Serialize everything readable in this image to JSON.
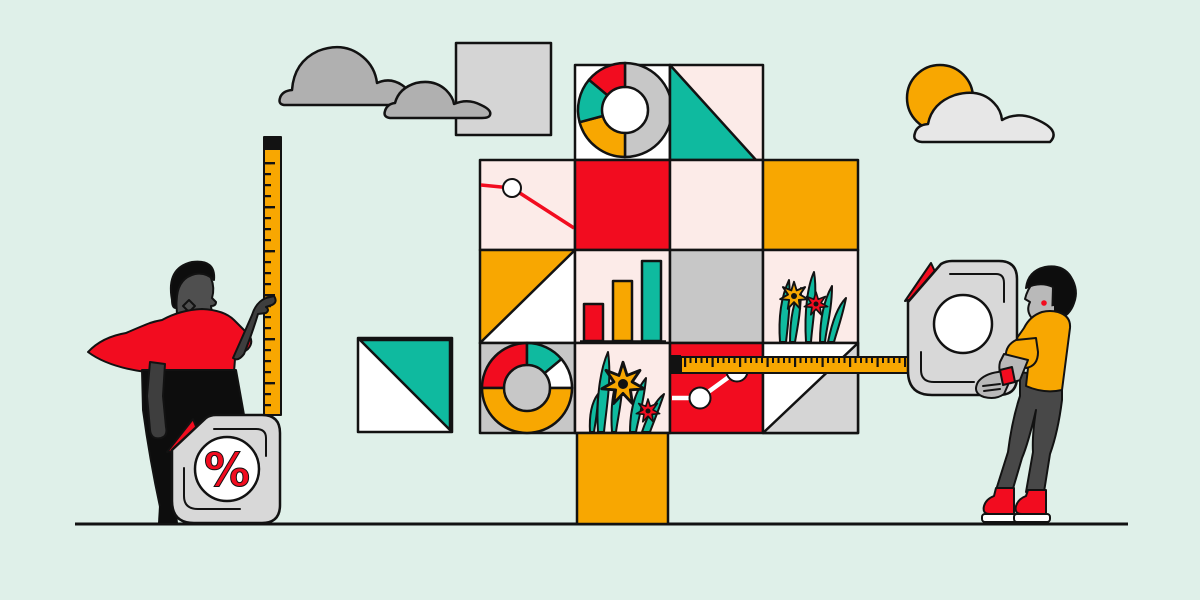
{
  "colors": {
    "bg": "#dff0e9",
    "outline": "#121212",
    "red": "#f20c1f",
    "orange": "#f8a701",
    "teal": "#0fba9f",
    "pink": "#fcebe8",
    "white": "#ffffff",
    "tile_grey": "#c7c7c7",
    "cloud_grey": "#b0b0b0",
    "square_grey": "#d5d5d5",
    "device_grey": "#d8d8d8",
    "light_cloud": "#e7e7e7",
    "skin_dark": "#3e3e3e",
    "face_dark": "#4f4f4f",
    "hair_black": "#0d0d0d",
    "skin_grey": "#b9b9b9",
    "pants_grey": "#484848",
    "gold": "#f8a701",
    "black": "#121212"
  },
  "percent_device": {
    "label": "%"
  },
  "scene": {
    "description_elements": [
      "clouds",
      "sun-behind-cloud",
      "grey-square",
      "teal-triangle-square",
      "chart-tile-tree",
      "vertical-ruler",
      "tape-measure-horizontal",
      "percent-tape-measure",
      "left-person",
      "right-person",
      "ground-line"
    ],
    "tree_tiles": [
      [
        "donut-chart",
        "teal-triangle"
      ],
      [
        "line-chart-red",
        "solid-red",
        "solid-pink",
        "solid-orange"
      ],
      [
        "orange-white-diagonal",
        "bar-chart",
        "solid-grey",
        "flowers"
      ],
      [
        "donut-chart-grey",
        "flowers-large",
        "line-chart-white-on-red",
        "white-grey-diagonal"
      ]
    ],
    "bar_chart_bars": [
      "red-short",
      "orange-medium",
      "teal-tall"
    ]
  }
}
